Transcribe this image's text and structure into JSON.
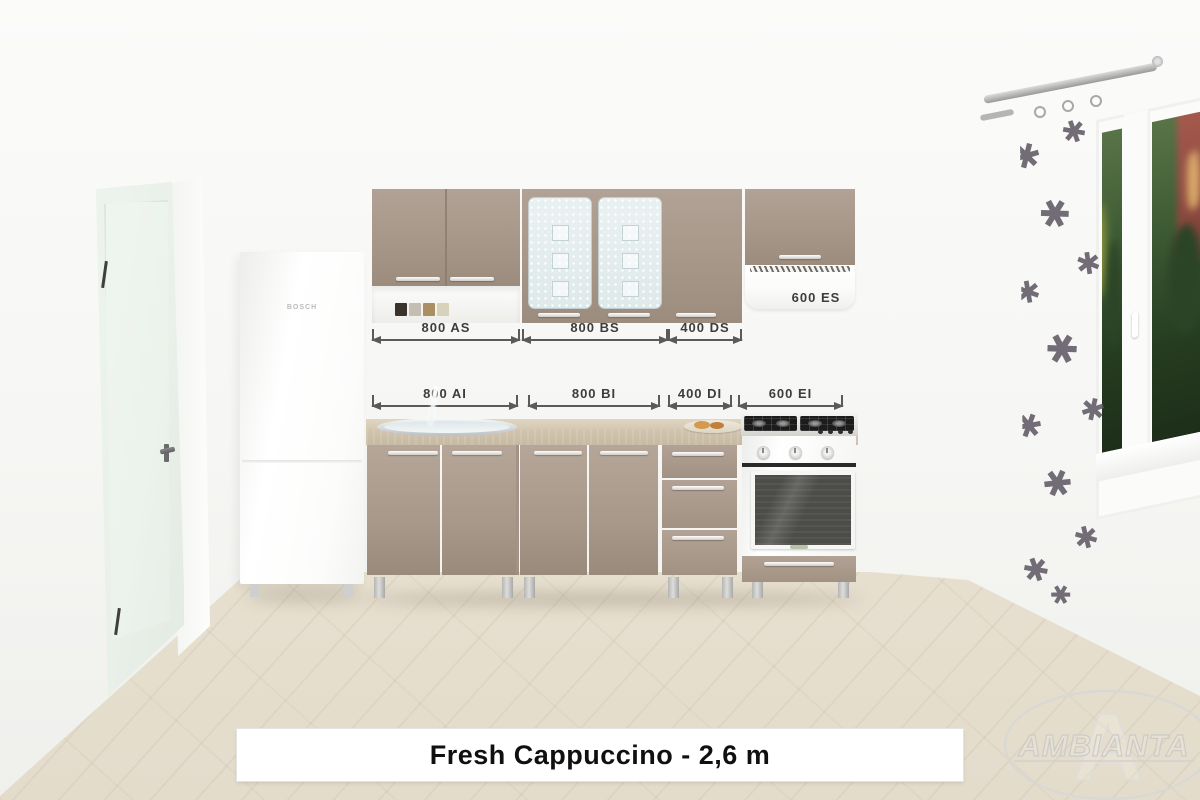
{
  "title_bar": {
    "label": "Fresh Cappuccino - 2,6 m"
  },
  "dims": {
    "upper": [
      {
        "label": "800 AS"
      },
      {
        "label": "800 BS"
      },
      {
        "label": "400 DS"
      }
    ],
    "hood_label": "600 ES",
    "lower": [
      {
        "label": "800 AI"
      },
      {
        "label": "800 BI"
      },
      {
        "label": "400 DI"
      },
      {
        "label": "600 EI"
      }
    ]
  },
  "appliances": {
    "fridge_logo": "BOSCH"
  },
  "watermark": {
    "letter": "A",
    "brand": "AMBIANTA"
  },
  "palette": {
    "cabinet_cappuccino": "#a79788",
    "counter": "#d8ccb6",
    "floor": "#e9e2d3",
    "wall": "#f7f7f5",
    "dim_text": "#3d3d3d",
    "title_text": "#101010"
  }
}
